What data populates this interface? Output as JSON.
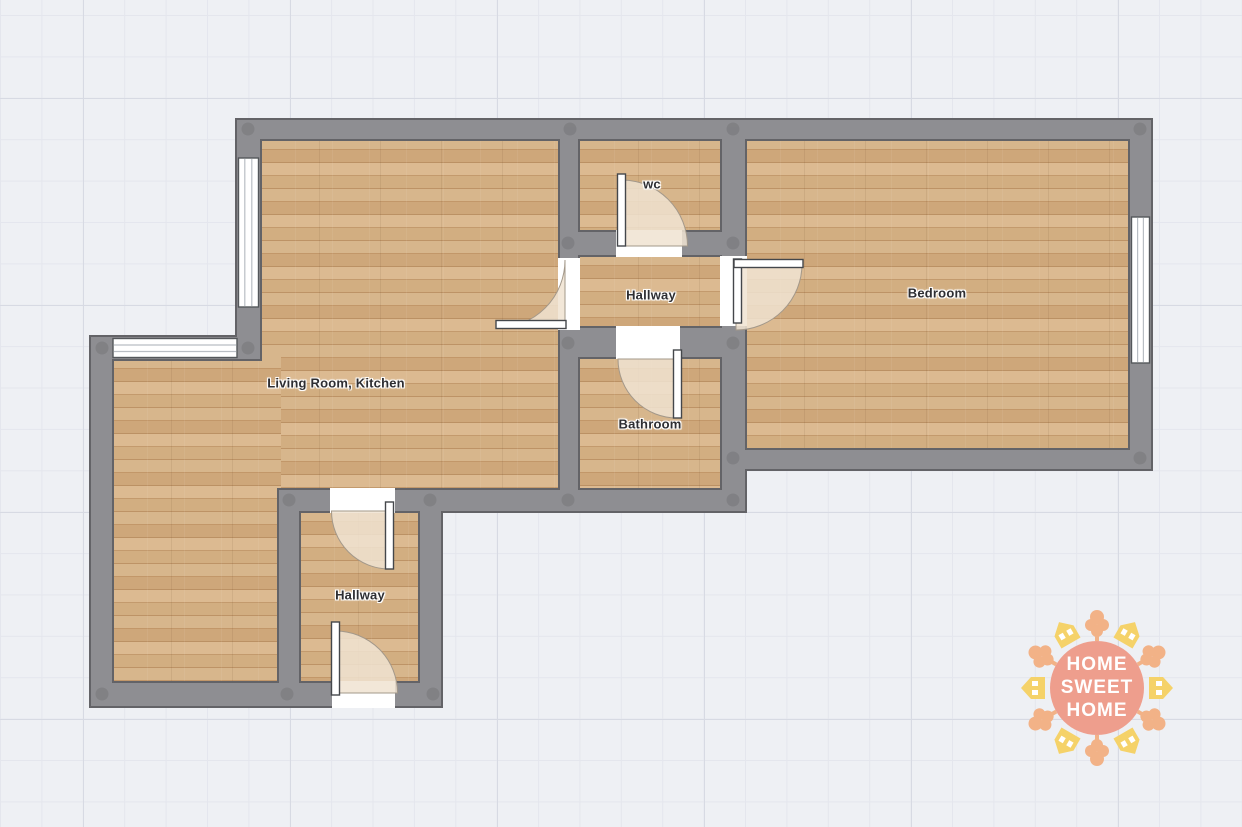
{
  "floor_plan": {
    "rooms": [
      {
        "id": "wc",
        "label": "wc"
      },
      {
        "id": "hallway-center",
        "label": "Hallway"
      },
      {
        "id": "bedroom",
        "label": "Bedroom"
      },
      {
        "id": "living-room-kitchen",
        "label": "Living Room, Kitchen"
      },
      {
        "id": "bathroom",
        "label": "Bathroom"
      },
      {
        "id": "hallway-lower",
        "label": "Hallway"
      }
    ],
    "watermark": {
      "lines": [
        "HOME",
        "SWEET",
        "HOME"
      ]
    },
    "colors": {
      "wall_fill": "#8e8e92",
      "wall_outline": "#636367",
      "floor_base": "#cda77b",
      "door_swing": "#f0e3d1",
      "background": "#eef0f4",
      "logo_circle": "#ee9e8d",
      "logo_house": "#f5d269",
      "logo_tree": "#f2b287"
    }
  }
}
